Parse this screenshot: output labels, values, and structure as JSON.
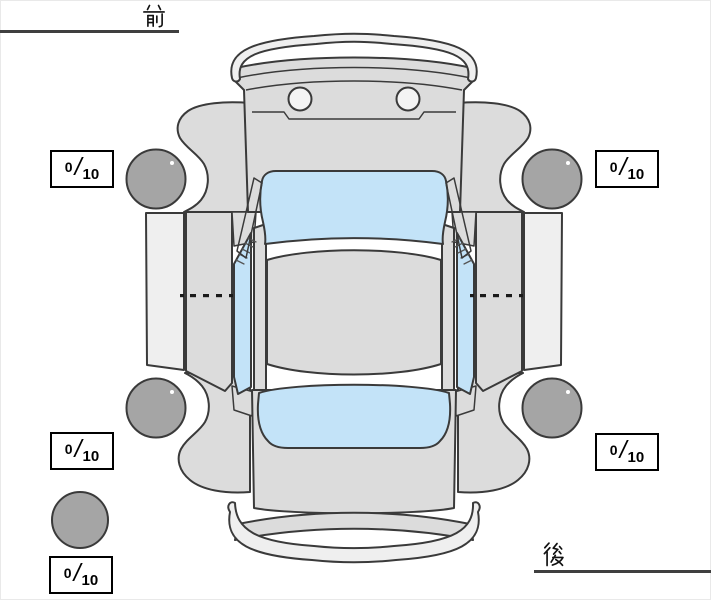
{
  "orientation": {
    "front_label": "前",
    "rear_label": "後"
  },
  "tire_scores": {
    "front_left": {
      "value": "0",
      "max": "10"
    },
    "front_right": {
      "value": "0",
      "max": "10"
    },
    "rear_left": {
      "value": "0",
      "max": "10"
    },
    "rear_right": {
      "value": "0",
      "max": "10"
    },
    "spare": {
      "value": "0",
      "max": "10"
    }
  },
  "score_separator": "/",
  "colors": {
    "body": "#dcdcdc",
    "trim": "#efefef",
    "glass": "#c3e3f8",
    "tire": "#a5a5a5",
    "outline": "#3a3a3a"
  }
}
